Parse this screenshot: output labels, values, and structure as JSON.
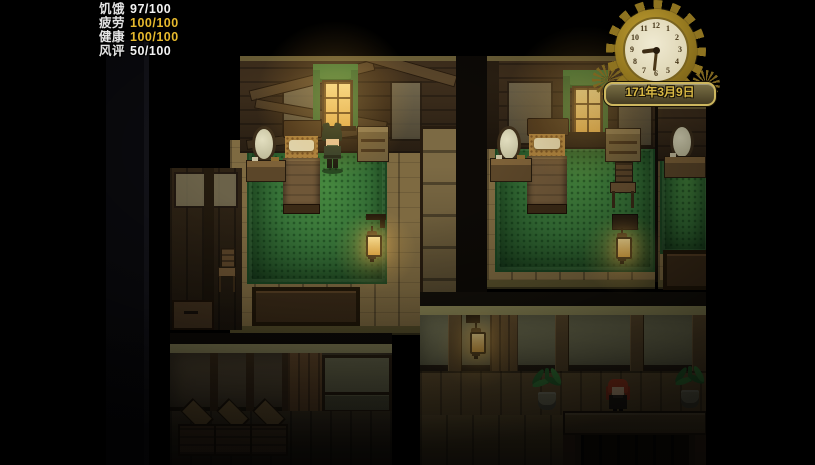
{
  "hud": {
    "stats": [
      {
        "label": "饥饿",
        "value": "97/100",
        "value_color": "#f2f2f2"
      },
      {
        "label": "疲劳",
        "value": "100/100",
        "value_color": "#e6b92d"
      },
      {
        "label": "健康",
        "value": "100/100",
        "value_color": "#e6b92d"
      },
      {
        "label": "风评",
        "value": "50/100",
        "value_color": "#f2f2f2"
      }
    ]
  },
  "clock": {
    "numerals": [
      "12",
      "1",
      "2",
      "3",
      "4",
      "5",
      "6",
      "7",
      "8",
      "9",
      "10",
      "11"
    ],
    "date": "171年3月9日",
    "hour_hand_transform": "rotate(263deg)",
    "minute_hand_transform": "rotate(186deg)"
  },
  "palette": {
    "background": "#000000",
    "hud_white": "#f2f2f2",
    "hud_gold": "#e6b92d",
    "gear_gold": "#8e7320",
    "clock_face": "#ece5cc",
    "date_text": "#d9b945",
    "carpet_green": "#37713a",
    "wood_floor": "#7e6a41",
    "wall_brown": "#3f2f1d",
    "lantern_glow": "#ffd57a",
    "curtain_green": "#4a7c3a",
    "npc_hair_red": "#bb4527",
    "player_hair": "#242f1d"
  },
  "scene": {
    "rooms": [
      "left-bedroom",
      "middle-bedroom",
      "right-bedroom-partial",
      "storage-room",
      "hallway"
    ],
    "characters": [
      "player",
      "innkeeper-npc"
    ]
  }
}
